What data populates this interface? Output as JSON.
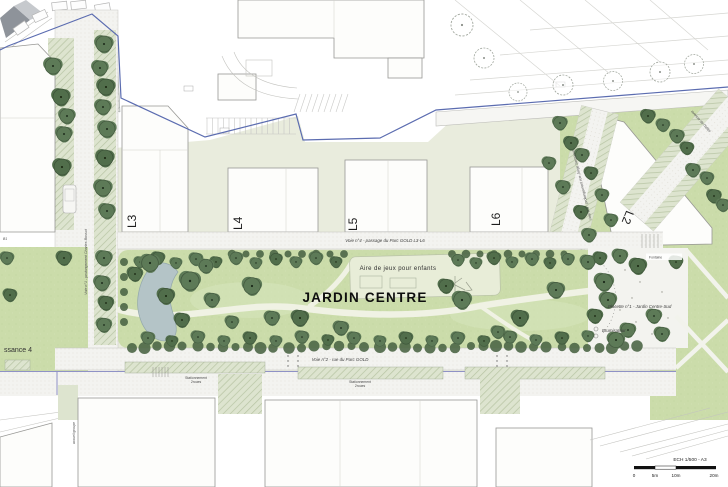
{
  "plan": {
    "labels": {
      "voie1": "Voie n°1 - prolongement Charles Bossut",
      "voie2": "Voie n°2 - rue du Parc GOLD",
      "voie3": "Voie n°3 - prolongement rue Jorge Semprun",
      "voie4": "Voie n°4 - passage du Parc GOLD L3-L6",
      "avenue": "avenue de l'hôtel",
      "garden": "JARDIN CENTRE",
      "playground": "Aire de jeux pour enfants",
      "placette": "Placette n°1 - Jardin Centre-Sud",
      "brumisateur": "Brumisateur",
      "fontaine": "Fontaine",
      "lawn": "ssance 4",
      "b1": "B1",
      "accueil": "accueil groupe",
      "stationnement": {
        "line1": "Stationnement",
        "line2": "2roues"
      },
      "parcels": {
        "l2": "L2",
        "l3": "L3",
        "l4": "L4",
        "l5": "L5",
        "l6": "L6"
      }
    },
    "scalebar": {
      "label": "ECH 1/500 - A3",
      "ticks": [
        "0",
        "5m",
        "10m",
        "20m"
      ]
    },
    "colors": {
      "boundary_blue": "#5b6cb0",
      "purple_line": "#8f92c6",
      "park_green": "#cbdcaa",
      "tree_green": "#5d7a57",
      "water": "#b4c4c7",
      "pale_ground": "#e9ecdd"
    }
  }
}
